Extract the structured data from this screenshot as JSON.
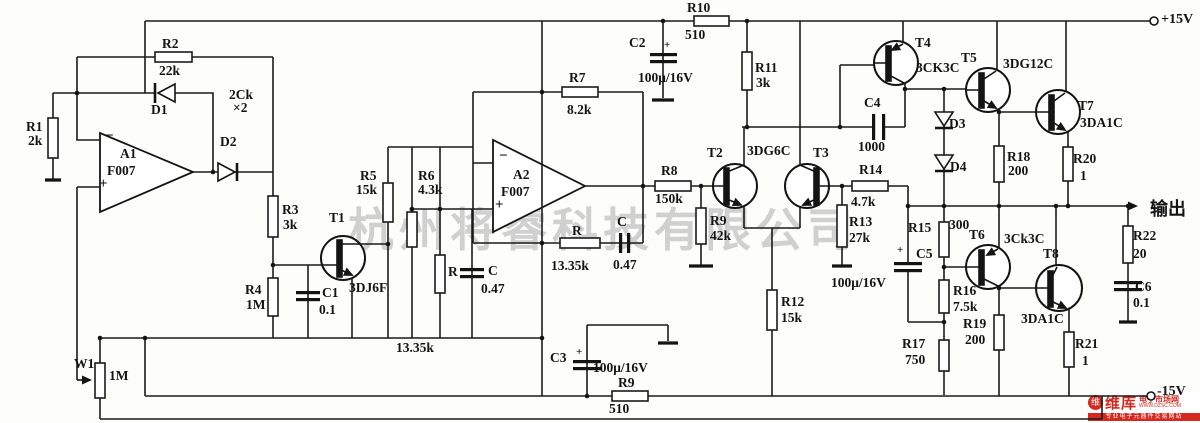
{
  "watermark": "杭州将睿科技有限公司",
  "logo": {
    "icon": "维",
    "title": "维库",
    "subtitle": "电子市场网",
    "url": "WWW.DZSC.COM",
    "tagline": "专业电子元器件交易网站"
  },
  "labels": [
    {
      "name": "r1",
      "x": 26,
      "y": 120,
      "text": "R1"
    },
    {
      "name": "r1-value",
      "x": 28,
      "y": 134,
      "text": "2k"
    },
    {
      "name": "r2",
      "x": 162,
      "y": 37,
      "text": "R2"
    },
    {
      "name": "r2-value",
      "x": 159,
      "y": 64,
      "text": "22k"
    },
    {
      "name": "d1",
      "x": 151,
      "y": 103,
      "text": "D1"
    },
    {
      "name": "d2",
      "x": 220,
      "y": 135,
      "text": "D2"
    },
    {
      "name": "diode-type",
      "x": 229,
      "y": 88,
      "text": "2Ck"
    },
    {
      "name": "diode-mult",
      "x": 233,
      "y": 101,
      "text": "×2"
    },
    {
      "name": "a1-minus",
      "x": 105,
      "y": 129,
      "text": "−",
      "size": 15
    },
    {
      "name": "a1",
      "x": 120,
      "y": 147,
      "text": "A1"
    },
    {
      "name": "a1-type",
      "x": 107,
      "y": 164,
      "text": "F007"
    },
    {
      "name": "a1-plus",
      "x": 99,
      "y": 177,
      "text": "+",
      "size": 15
    },
    {
      "name": "r3",
      "x": 282,
      "y": 203,
      "text": "R3"
    },
    {
      "name": "r3-value",
      "x": 283,
      "y": 218,
      "text": "3k"
    },
    {
      "name": "r4",
      "x": 245,
      "y": 283,
      "text": "R4"
    },
    {
      "name": "r4-value",
      "x": 246,
      "y": 298,
      "text": "1M"
    },
    {
      "name": "t1",
      "x": 329,
      "y": 211,
      "text": "T1"
    },
    {
      "name": "t1-type",
      "x": 349,
      "y": 281,
      "text": "3DJ6F"
    },
    {
      "name": "c1",
      "x": 322,
      "y": 286,
      "text": "C1"
    },
    {
      "name": "c1-value",
      "x": 319,
      "y": 303,
      "text": "0.1"
    },
    {
      "name": "w1",
      "x": 74,
      "y": 357,
      "text": "W1"
    },
    {
      "name": "w1-value",
      "x": 109,
      "y": 369,
      "text": "1M"
    },
    {
      "name": "r5",
      "x": 360,
      "y": 169,
      "text": "R5"
    },
    {
      "name": "r5-value",
      "x": 356,
      "y": 183,
      "text": "15k"
    },
    {
      "name": "r6",
      "x": 418,
      "y": 169,
      "text": "R6"
    },
    {
      "name": "r6-value",
      "x": 418,
      "y": 183,
      "text": "4.3k"
    },
    {
      "name": "r-mid",
      "x": 448,
      "y": 265,
      "text": "R"
    },
    {
      "name": "c-mid",
      "x": 488,
      "y": 264,
      "text": "C"
    },
    {
      "name": "c-mid-value",
      "x": 481,
      "y": 282,
      "text": "0.47"
    },
    {
      "name": "r-mid-value",
      "x": 396,
      "y": 341,
      "text": "13.35k"
    },
    {
      "name": "a2-minus",
      "x": 499,
      "y": 149,
      "text": "−",
      "size": 15
    },
    {
      "name": "a2",
      "x": 513,
      "y": 168,
      "text": "A2"
    },
    {
      "name": "a2-type",
      "x": 501,
      "y": 185,
      "text": "F007"
    },
    {
      "name": "a2-plus",
      "x": 495,
      "y": 198,
      "text": "+",
      "size": 15
    },
    {
      "name": "r7",
      "x": 569,
      "y": 71,
      "text": "R7"
    },
    {
      "name": "r7-value",
      "x": 567,
      "y": 103,
      "text": "8.2k"
    },
    {
      "name": "r-fb",
      "x": 572,
      "y": 224,
      "text": "R"
    },
    {
      "name": "r-fb-value",
      "x": 551,
      "y": 259,
      "text": "13.35k"
    },
    {
      "name": "c-fb",
      "x": 617,
      "y": 215,
      "text": "C"
    },
    {
      "name": "c-fb-value",
      "x": 613,
      "y": 258,
      "text": "0.47"
    },
    {
      "name": "c2",
      "x": 629,
      "y": 36,
      "text": "C2"
    },
    {
      "name": "c2-plus",
      "x": 664,
      "y": 40,
      "text": "+",
      "size": 11
    },
    {
      "name": "c2-value",
      "x": 638,
      "y": 71,
      "text": "100μ/16V"
    },
    {
      "name": "r10",
      "x": 687,
      "y": 1,
      "text": "R10"
    },
    {
      "name": "r10-value",
      "x": 685,
      "y": 28,
      "text": "510"
    },
    {
      "name": "r8",
      "x": 661,
      "y": 164,
      "text": "R8"
    },
    {
      "name": "r8-value",
      "x": 655,
      "y": 192,
      "text": "150k"
    },
    {
      "name": "r9a",
      "x": 710,
      "y": 214,
      "text": "R9"
    },
    {
      "name": "r9a-value",
      "x": 710,
      "y": 229,
      "text": "42k"
    },
    {
      "name": "r11",
      "x": 755,
      "y": 61,
      "text": "R11"
    },
    {
      "name": "r11-value",
      "x": 756,
      "y": 76,
      "text": "3k"
    },
    {
      "name": "t2",
      "x": 707,
      "y": 146,
      "text": "T2"
    },
    {
      "name": "t2-t3-type",
      "x": 747,
      "y": 144,
      "text": "3DG6C"
    },
    {
      "name": "t3",
      "x": 813,
      "y": 146,
      "text": "T3"
    },
    {
      "name": "r12",
      "x": 781,
      "y": 295,
      "text": "R12"
    },
    {
      "name": "r12-value",
      "x": 781,
      "y": 311,
      "text": "15k"
    },
    {
      "name": "c3",
      "x": 550,
      "y": 351,
      "text": "C3"
    },
    {
      "name": "c3-plus",
      "x": 576,
      "y": 347,
      "text": "+",
      "size": 11
    },
    {
      "name": "c3-value",
      "x": 593,
      "y": 361,
      "text": "100μ/16V"
    },
    {
      "name": "r9b",
      "x": 618,
      "y": 376,
      "text": "R9"
    },
    {
      "name": "r9b-value",
      "x": 609,
      "y": 402,
      "text": "510"
    },
    {
      "name": "r13",
      "x": 849,
      "y": 215,
      "text": "R13"
    },
    {
      "name": "r13-value",
      "x": 849,
      "y": 231,
      "text": "27k"
    },
    {
      "name": "r14",
      "x": 859,
      "y": 163,
      "text": "R14"
    },
    {
      "name": "r14-value",
      "x": 851,
      "y": 195,
      "text": "4.7k"
    },
    {
      "name": "c4",
      "x": 864,
      "y": 96,
      "text": "C4"
    },
    {
      "name": "c4-value",
      "x": 858,
      "y": 140,
      "text": "1000"
    },
    {
      "name": "t4",
      "x": 915,
      "y": 36,
      "text": "T4"
    },
    {
      "name": "t4-type",
      "x": 916,
      "y": 61,
      "text": "3CK3C"
    },
    {
      "name": "d3",
      "x": 949,
      "y": 117,
      "text": "D3"
    },
    {
      "name": "d4",
      "x": 950,
      "y": 160,
      "text": "D4"
    },
    {
      "name": "t5",
      "x": 961,
      "y": 51,
      "text": "T5"
    },
    {
      "name": "t5-type",
      "x": 1003,
      "y": 57,
      "text": "3DG12C"
    },
    {
      "name": "t7",
      "x": 1078,
      "y": 99,
      "text": "T7"
    },
    {
      "name": "t7-type",
      "x": 1080,
      "y": 116,
      "text": "3DA1C"
    },
    {
      "name": "r18",
      "x": 1007,
      "y": 150,
      "text": "R18"
    },
    {
      "name": "r18-value",
      "x": 1008,
      "y": 164,
      "text": "200"
    },
    {
      "name": "r20",
      "x": 1073,
      "y": 152,
      "text": "R20"
    },
    {
      "name": "r20-value",
      "x": 1080,
      "y": 169,
      "text": "1"
    },
    {
      "name": "r15",
      "x": 908,
      "y": 221,
      "text": "R15"
    },
    {
      "name": "r15-value",
      "x": 949,
      "y": 218,
      "text": "300"
    },
    {
      "name": "c5",
      "x": 916,
      "y": 247,
      "text": "C5"
    },
    {
      "name": "c5-plus",
      "x": 897,
      "y": 245,
      "text": "+",
      "size": 11
    },
    {
      "name": "c5-value",
      "x": 831,
      "y": 276,
      "text": "100μ/16V"
    },
    {
      "name": "t6",
      "x": 969,
      "y": 228,
      "text": "T6"
    },
    {
      "name": "t6-type",
      "x": 1004,
      "y": 232,
      "text": "3Ck3C"
    },
    {
      "name": "r16",
      "x": 953,
      "y": 284,
      "text": "R16"
    },
    {
      "name": "r16-value",
      "x": 953,
      "y": 300,
      "text": "7.5k"
    },
    {
      "name": "t8",
      "x": 1043,
      "y": 247,
      "text": "T8"
    },
    {
      "name": "t8-type",
      "x": 1021,
      "y": 312,
      "text": "3DA1C"
    },
    {
      "name": "r17",
      "x": 902,
      "y": 337,
      "text": "R17"
    },
    {
      "name": "r17-value",
      "x": 905,
      "y": 353,
      "text": "750"
    },
    {
      "name": "r19",
      "x": 963,
      "y": 317,
      "text": "R19"
    },
    {
      "name": "r19-value",
      "x": 965,
      "y": 333,
      "text": "200"
    },
    {
      "name": "r21",
      "x": 1075,
      "y": 337,
      "text": "R21"
    },
    {
      "name": "r21-value",
      "x": 1082,
      "y": 354,
      "text": "1"
    },
    {
      "name": "r22",
      "x": 1133,
      "y": 229,
      "text": "R22"
    },
    {
      "name": "r22-value",
      "x": 1133,
      "y": 247,
      "text": "20"
    },
    {
      "name": "c6",
      "x": 1135,
      "y": 280,
      "text": "C6"
    },
    {
      "name": "c6-value",
      "x": 1133,
      "y": 296,
      "text": "0.1"
    },
    {
      "name": "terminal-plus15",
      "x": 1161,
      "y": 13,
      "text": "+15V",
      "size": 14
    },
    {
      "name": "terminal-minus15",
      "x": 1157,
      "y": 385,
      "text": "-15V",
      "size": 14
    },
    {
      "name": "output-label",
      "x": 1150,
      "y": 200,
      "text": "输出",
      "size": 18
    }
  ]
}
